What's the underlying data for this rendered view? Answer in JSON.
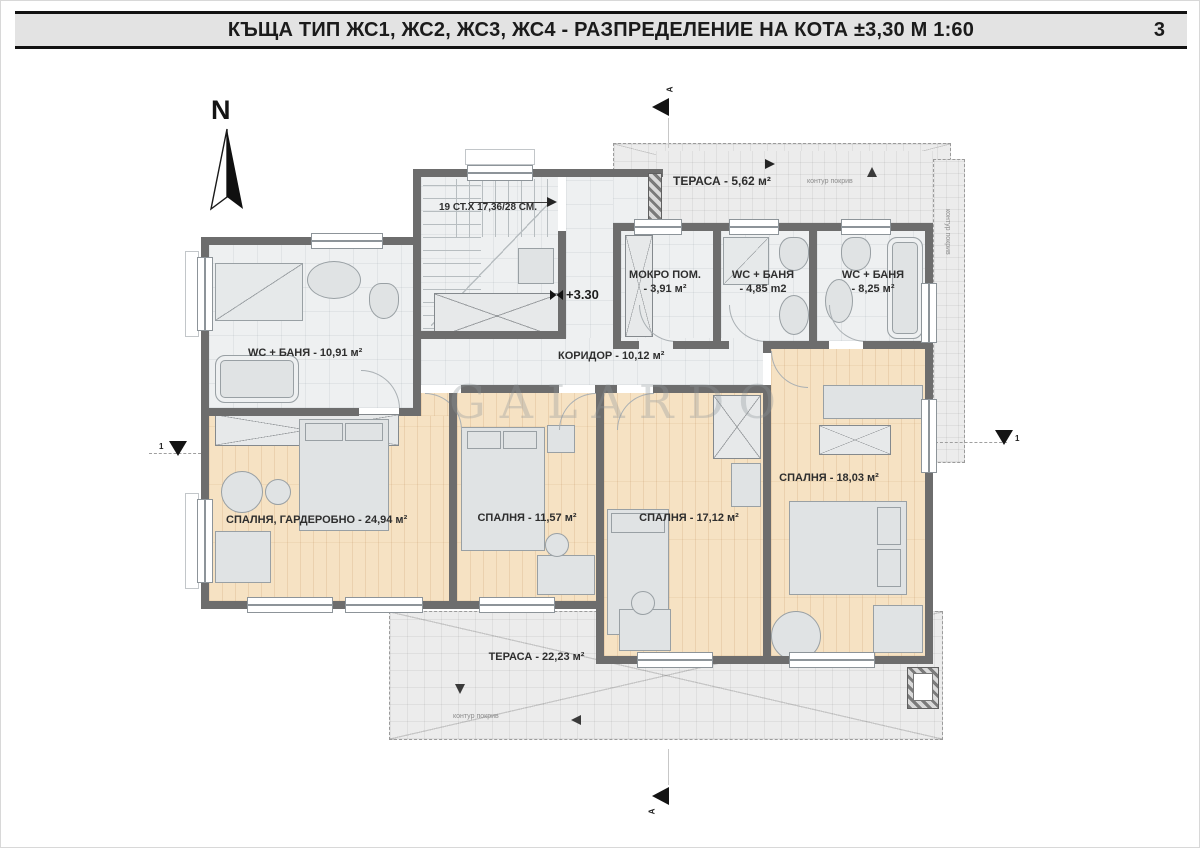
{
  "title_bar": {
    "title": "КЪЩА ТИП ЖС1, ЖС2, ЖС3, ЖС4 - РАЗПРЕДЕЛЕНИЕ НА КОТА ±3,30 М 1:60",
    "page_number": "3"
  },
  "compass": {
    "north_label": "N"
  },
  "watermark": {
    "text": "GALARDO"
  },
  "plan": {
    "elevation_marker": "+3.30",
    "stairs_note": "19 СТ.Х 17,36/28 СМ.",
    "roof_contour_label": "контур покрив",
    "section_label": "A",
    "axis_label": "1",
    "rooms": {
      "terrace_top": "ТЕРАСА - 5,62 м²",
      "mokro_name": "МОКРО ПОМ.",
      "mokro_area": "- 3,91 м²",
      "wc1_name": "WC + БАНЯ",
      "wc1_area": "- 4,85 m2",
      "wc2_name": "WC + БАНЯ",
      "wc2_area": "- 8,25 м²",
      "wc3": "WC + БАНЯ - 10,91 м²",
      "corridor": "КОРИДОР - 10,12 м²",
      "master": "СПАЛНЯ, ГАРДЕРОБНО - 24,94 м²",
      "bed1": "СПАЛНЯ - 11,57 м²",
      "bed2": "СПАЛНЯ - 17,12 м²",
      "bed3": "СПАЛНЯ - 18,03 м²",
      "terrace_bottom": "ТЕРАСА - 22,23 м²"
    }
  },
  "colors": {
    "wall": "#6d6d6d",
    "wood_floor": "#f6e2c3",
    "tile_floor": "#eef0f1",
    "terrace": "#ececec",
    "title_band": "#e3e3e3"
  }
}
